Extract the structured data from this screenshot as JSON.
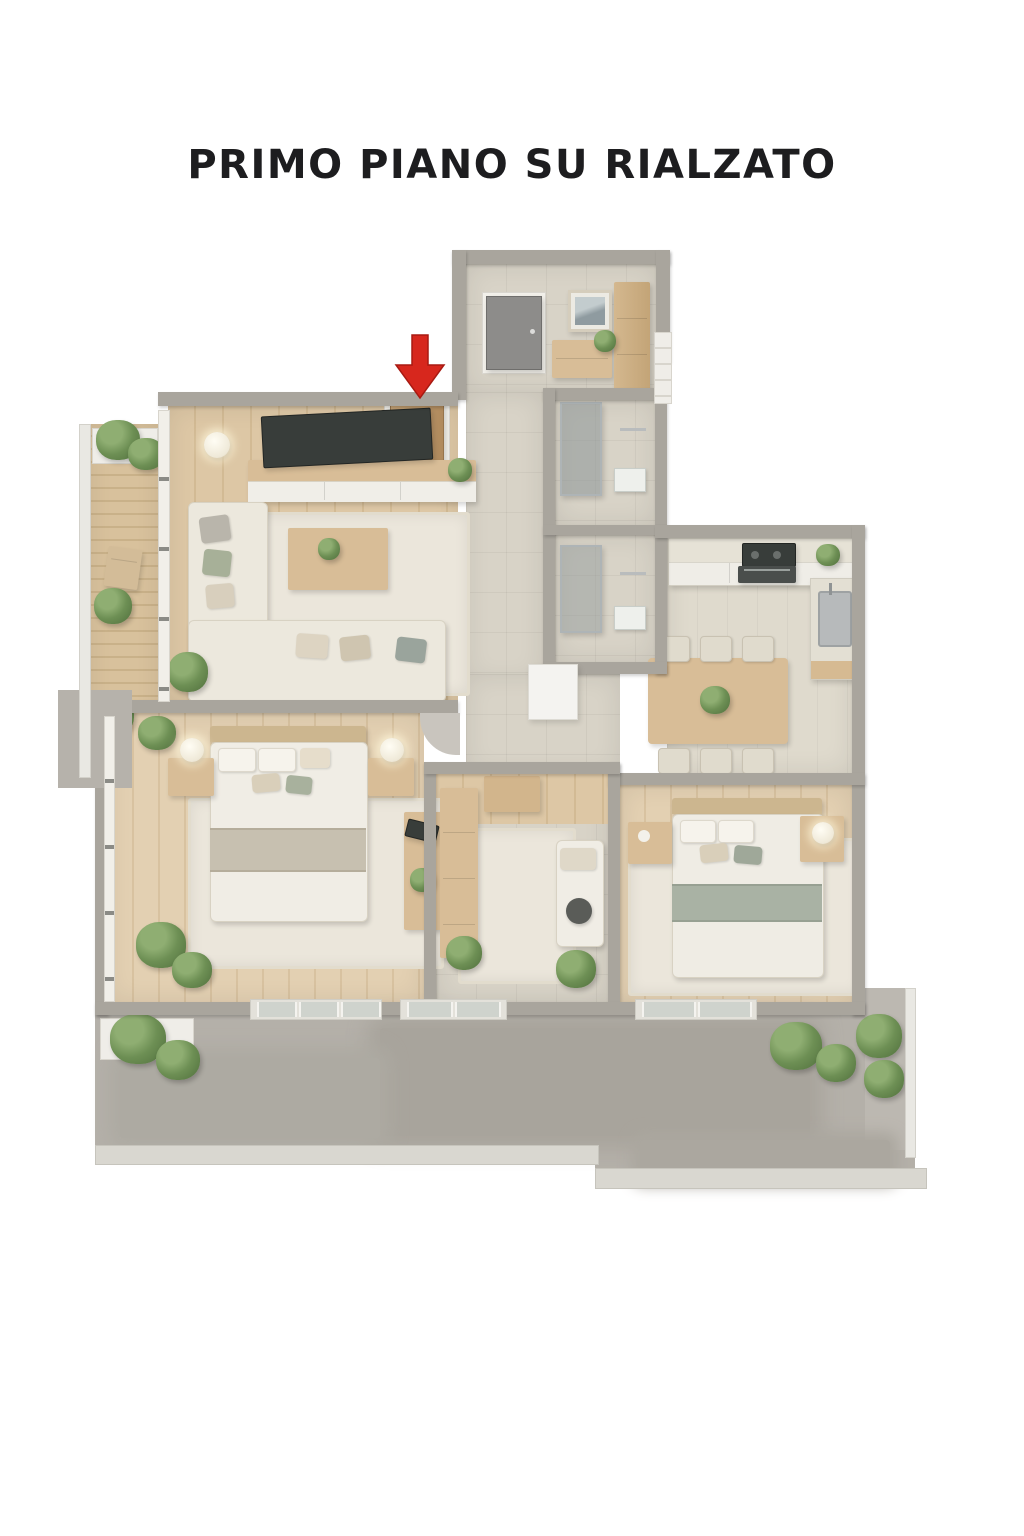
{
  "title": "PRIMO PIANO SU RIALZATO",
  "floor_plan": {
    "type": "isometric-3d-apartment-render",
    "marker": {
      "shape": "red-arrow-down",
      "color": "#d7271d",
      "points_to": "apartment-entrance-door"
    },
    "rooms": [
      {
        "id": "entrance-hall",
        "floor": "tile",
        "furniture": [
          "front-door",
          "picture-frame",
          "sideboard",
          "wardrobe-cabinet"
        ]
      },
      {
        "id": "living-room",
        "floor": "wood",
        "furniture": [
          "tv",
          "tv-console",
          "floor-lamp",
          "corner-sofa",
          "coffee-table",
          "rug",
          "entrance-door"
        ]
      },
      {
        "id": "balcony-left",
        "floor": "deck",
        "furniture": [
          "planter",
          "plants",
          "chair",
          "glass-railing"
        ]
      },
      {
        "id": "hallway",
        "floor": "tile",
        "furniture": []
      },
      {
        "id": "bathroom-1",
        "floor": "tile",
        "furniture": [
          "shower",
          "towels"
        ]
      },
      {
        "id": "bathroom-2",
        "floor": "tile",
        "furniture": [
          "shower",
          "towels"
        ]
      },
      {
        "id": "kitchen-dining",
        "floor": "stone",
        "furniture": [
          "kitchen-counter",
          "cooktop",
          "oven",
          "sink-unit",
          "dining-table",
          "chairs"
        ]
      },
      {
        "id": "bedroom-1",
        "floor": "wood",
        "furniture": [
          "double-bed",
          "nightstand-left",
          "nightstand-right",
          "lamps",
          "rug",
          "desk",
          "tv"
        ]
      },
      {
        "id": "study",
        "floor": "tile",
        "furniture": [
          "shelf-unit",
          "cabinet",
          "daybed",
          "rug"
        ]
      },
      {
        "id": "bedroom-2",
        "floor": "wood",
        "furniture": [
          "double-bed",
          "nightstand-left",
          "nightstand-right",
          "lamp",
          "rug"
        ]
      },
      {
        "id": "terrace-bottom",
        "floor": "concrete",
        "furniture": [
          "plants",
          "planter",
          "glass-railing",
          "stone-curb"
        ]
      }
    ],
    "colors": {
      "walls": "#a9a59d",
      "wood_floor": "#d8c2a0",
      "tile_floor": "#d8d3c7",
      "rug": "#ebe6db",
      "upholstery": "#ece8dd",
      "wood_furniture": "#d8bd97",
      "accent_sage": "#a7b098",
      "arrow_red": "#d7271d",
      "terrace_gray": "#b4b0a9",
      "title_text": "#1d1d1f",
      "background": "#ffffff"
    }
  }
}
